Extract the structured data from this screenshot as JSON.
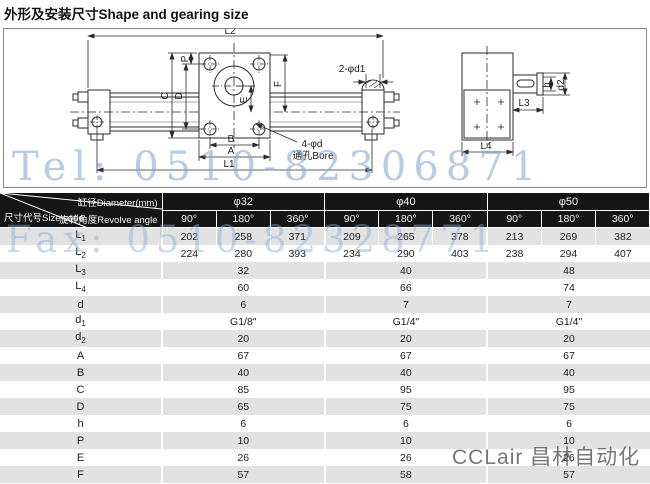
{
  "title": "外形及安装尺寸Shape and gearing size",
  "watermarks": {
    "tel": "Tel: 0510-82306871",
    "fax": "Fax: 0510-82328771",
    "brand": "CCLair 昌林自动化"
  },
  "colors": {
    "header_bg": "#161616",
    "row_alt_gray": "#e2e2e2",
    "watermark_blue": "#89a8d4",
    "brand_gray": "#5f5f5f"
  },
  "drawing": {
    "labels": {
      "L1": "L1",
      "L2": "L2",
      "L3": "L3",
      "L4": "L4",
      "A": "A",
      "B": "B",
      "C": "C",
      "D": "D",
      "E": "E",
      "F": "F",
      "P": "P",
      "h": "h",
      "d2": "d2",
      "ports": "2-φd1",
      "bore": "4-φd",
      "bore_cn": "通孔Bore"
    }
  },
  "table": {
    "corner": {
      "diameter": "缸径Diameter(mm)",
      "angle": "旋转角度Revolve angle",
      "size_code": "尺寸代号Size code"
    },
    "groups": [
      {
        "label": "φ32"
      },
      {
        "label": "φ40"
      },
      {
        "label": "φ50"
      }
    ],
    "angles": [
      "90°",
      "180°",
      "360°"
    ],
    "rows": [
      {
        "code": "L",
        "sub": "1",
        "merged": false,
        "values": [
          "202",
          "258",
          "371",
          "209",
          "265",
          "378",
          "213",
          "269",
          "382"
        ]
      },
      {
        "code": "L",
        "sub": "2",
        "merged": false,
        "values": [
          "224",
          "280",
          "393",
          "234",
          "290",
          "403",
          "238",
          "294",
          "407"
        ]
      },
      {
        "code": "L",
        "sub": "3",
        "merged": true,
        "values": [
          "32",
          "40",
          "48"
        ]
      },
      {
        "code": "L",
        "sub": "4",
        "merged": true,
        "values": [
          "60",
          "66",
          "74"
        ]
      },
      {
        "code": "d",
        "sub": "",
        "merged": true,
        "values": [
          "6",
          "7",
          "7"
        ]
      },
      {
        "code": "d",
        "sub": "1",
        "merged": true,
        "values": [
          "G1/8\"",
          "G1/4\"",
          "G1/4\""
        ]
      },
      {
        "code": "d",
        "sub": "2",
        "merged": true,
        "values": [
          "20",
          "20",
          "20"
        ]
      },
      {
        "code": "A",
        "sub": "",
        "merged": true,
        "values": [
          "67",
          "67",
          "67"
        ]
      },
      {
        "code": "B",
        "sub": "",
        "merged": true,
        "values": [
          "40",
          "40",
          "40"
        ]
      },
      {
        "code": "C",
        "sub": "",
        "merged": true,
        "values": [
          "85",
          "95",
          "95"
        ]
      },
      {
        "code": "D",
        "sub": "",
        "merged": true,
        "values": [
          "65",
          "75",
          "75"
        ]
      },
      {
        "code": "h",
        "sub": "",
        "merged": true,
        "values": [
          "6",
          "6",
          "6"
        ]
      },
      {
        "code": "P",
        "sub": "",
        "merged": true,
        "values": [
          "10",
          "10",
          "10"
        ]
      },
      {
        "code": "E",
        "sub": "",
        "merged": true,
        "values": [
          "26",
          "26",
          "26"
        ]
      },
      {
        "code": "F",
        "sub": "",
        "merged": true,
        "values": [
          "57",
          "58",
          "57"
        ]
      }
    ]
  }
}
